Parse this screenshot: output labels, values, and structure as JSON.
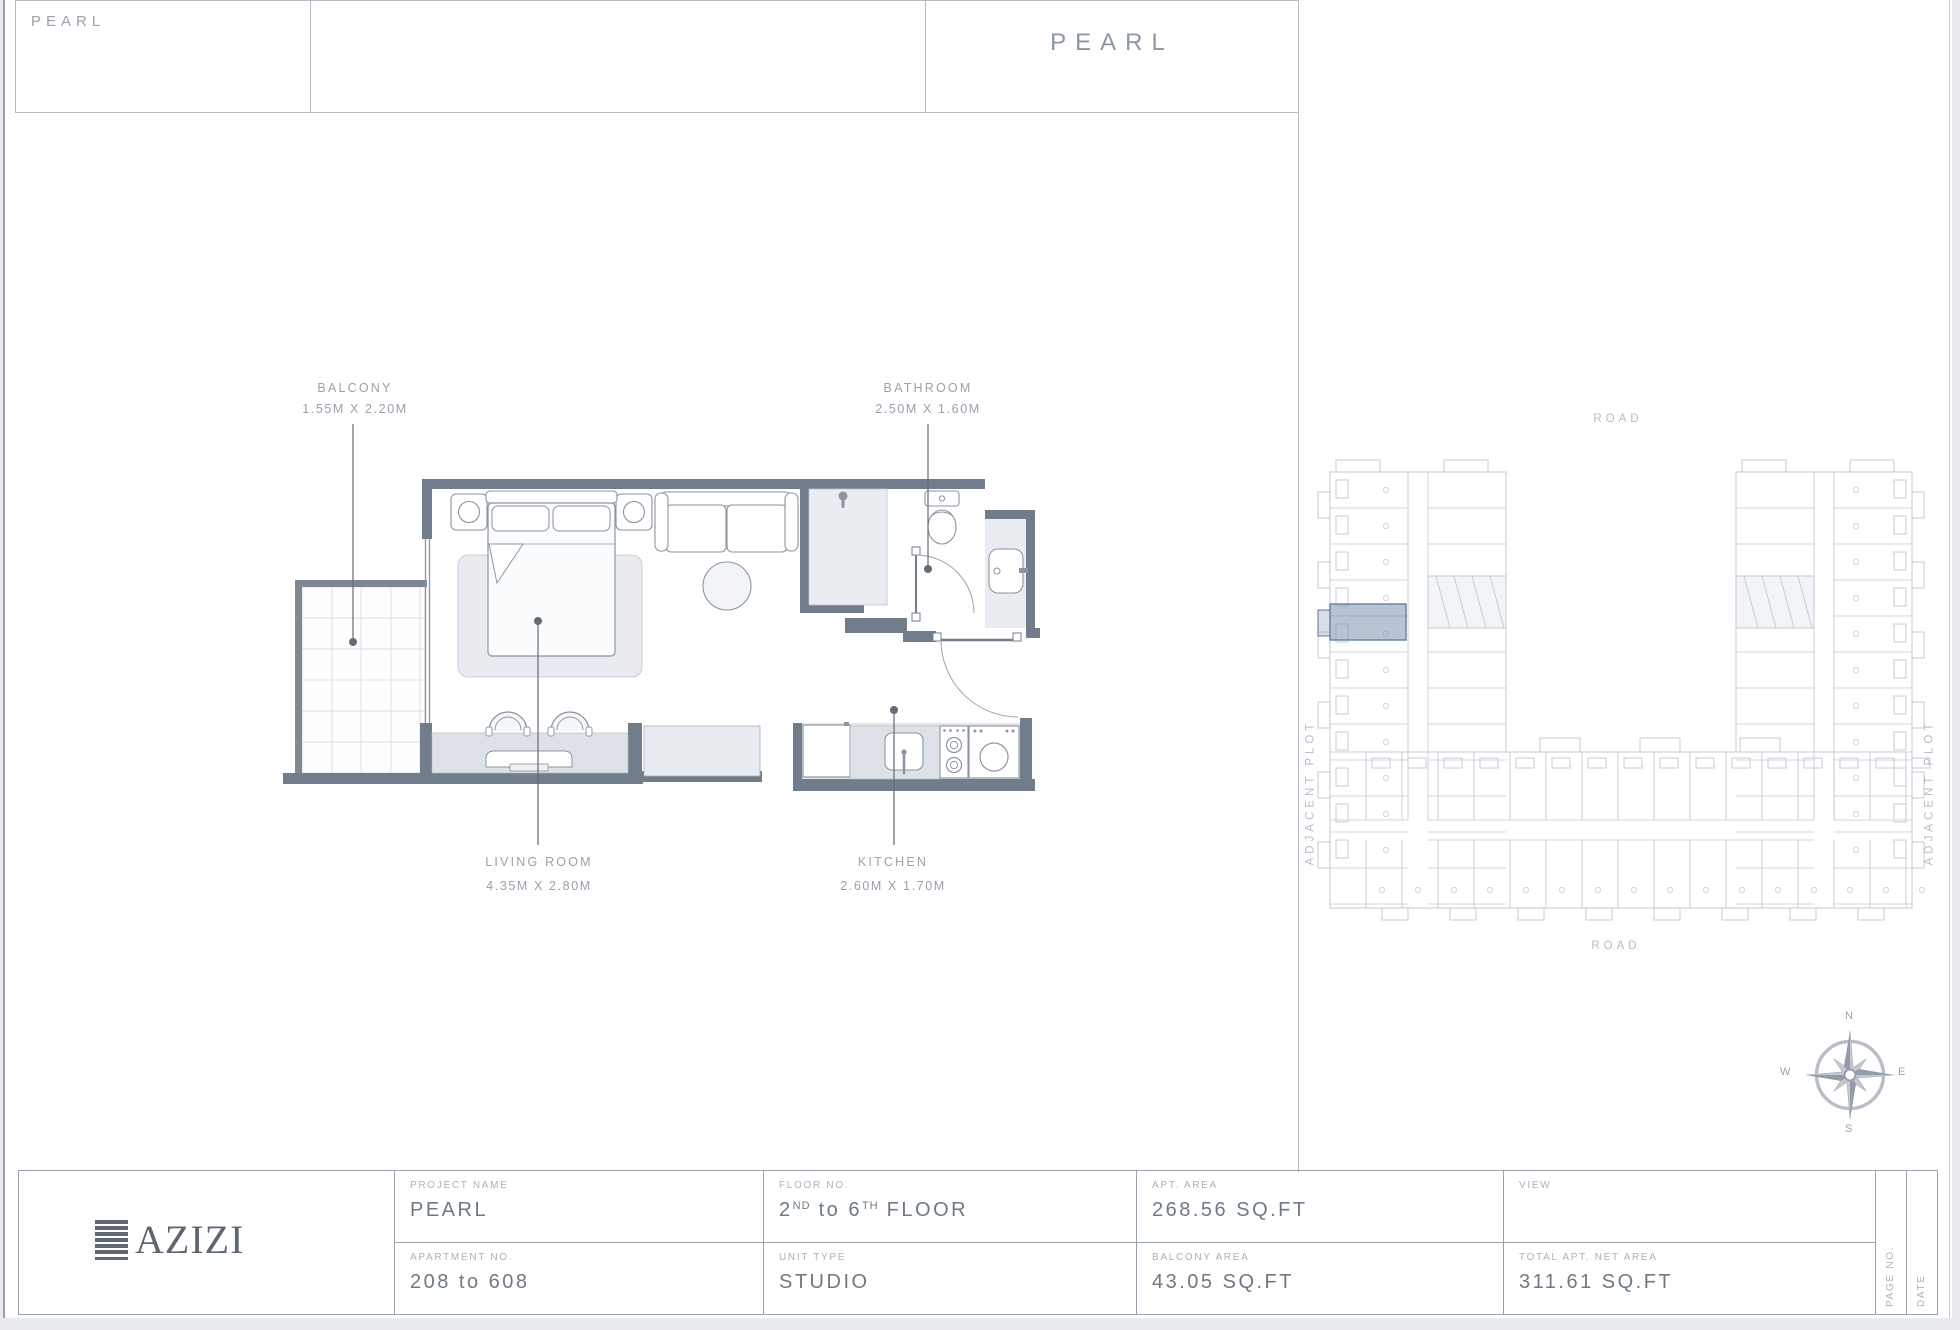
{
  "header": {
    "small_title": "PEARL",
    "main_title": "PEARL"
  },
  "floor_plan": {
    "labels": [
      {
        "id": "balcony",
        "name": "BALCONY",
        "dims": "1.55M X 2.20M"
      },
      {
        "id": "bathroom",
        "name": "BATHROOM",
        "dims": "2.50M X 1.60M"
      },
      {
        "id": "living",
        "name": "LIVING ROOM",
        "dims": "4.35M X 2.80M"
      },
      {
        "id": "kitchen",
        "name": "KITCHEN",
        "dims": "2.60M X 1.70M"
      }
    ]
  },
  "key_plan": {
    "road_top": "ROAD",
    "road_bottom": "ROAD",
    "adjacent_plot_left": "ADJACENT PLOT",
    "adjacent_plot_right": "ADJACENT PLOT"
  },
  "compass": {
    "n": "N",
    "e": "E",
    "s": "S",
    "w": "W"
  },
  "title_block": {
    "logo": "AZIZI",
    "project_name": {
      "label": "PROJECT NAME",
      "value": "PEARL"
    },
    "apartment_no": {
      "label": "APARTMENT NO.",
      "value": "208 to 608"
    },
    "floor_no": {
      "label": "FLOOR NO.",
      "parts": [
        {
          "t": "2"
        },
        {
          "t": "ND",
          "sup": true
        },
        {
          "t": " to "
        },
        {
          "t": "6"
        },
        {
          "t": "TH",
          "sup": true
        },
        {
          "t": " FLOOR"
        }
      ]
    },
    "unit_type": {
      "label": "UNIT TYPE",
      "value": "STUDIO"
    },
    "apt_area": {
      "label": "APT. AREA",
      "value": "268.56 SQ.FT"
    },
    "balcony_area": {
      "label": "BALCONY AREA",
      "value": "43.05 SQ.FT"
    },
    "view": {
      "label": "VIEW",
      "value": ""
    },
    "total_area": {
      "label": "TOTAL APT. NET AREA",
      "value": "311.61 SQ.FT"
    },
    "page_no_label": "PAGE NO.",
    "date_label": "DATE"
  },
  "colors": {
    "wall": "#717d8a",
    "furniture_line": "#8b95a1",
    "keyplan_line": "#bfc7d1",
    "highlight_fill": "#7e93ae",
    "highlight_stroke": "#5f7795"
  }
}
